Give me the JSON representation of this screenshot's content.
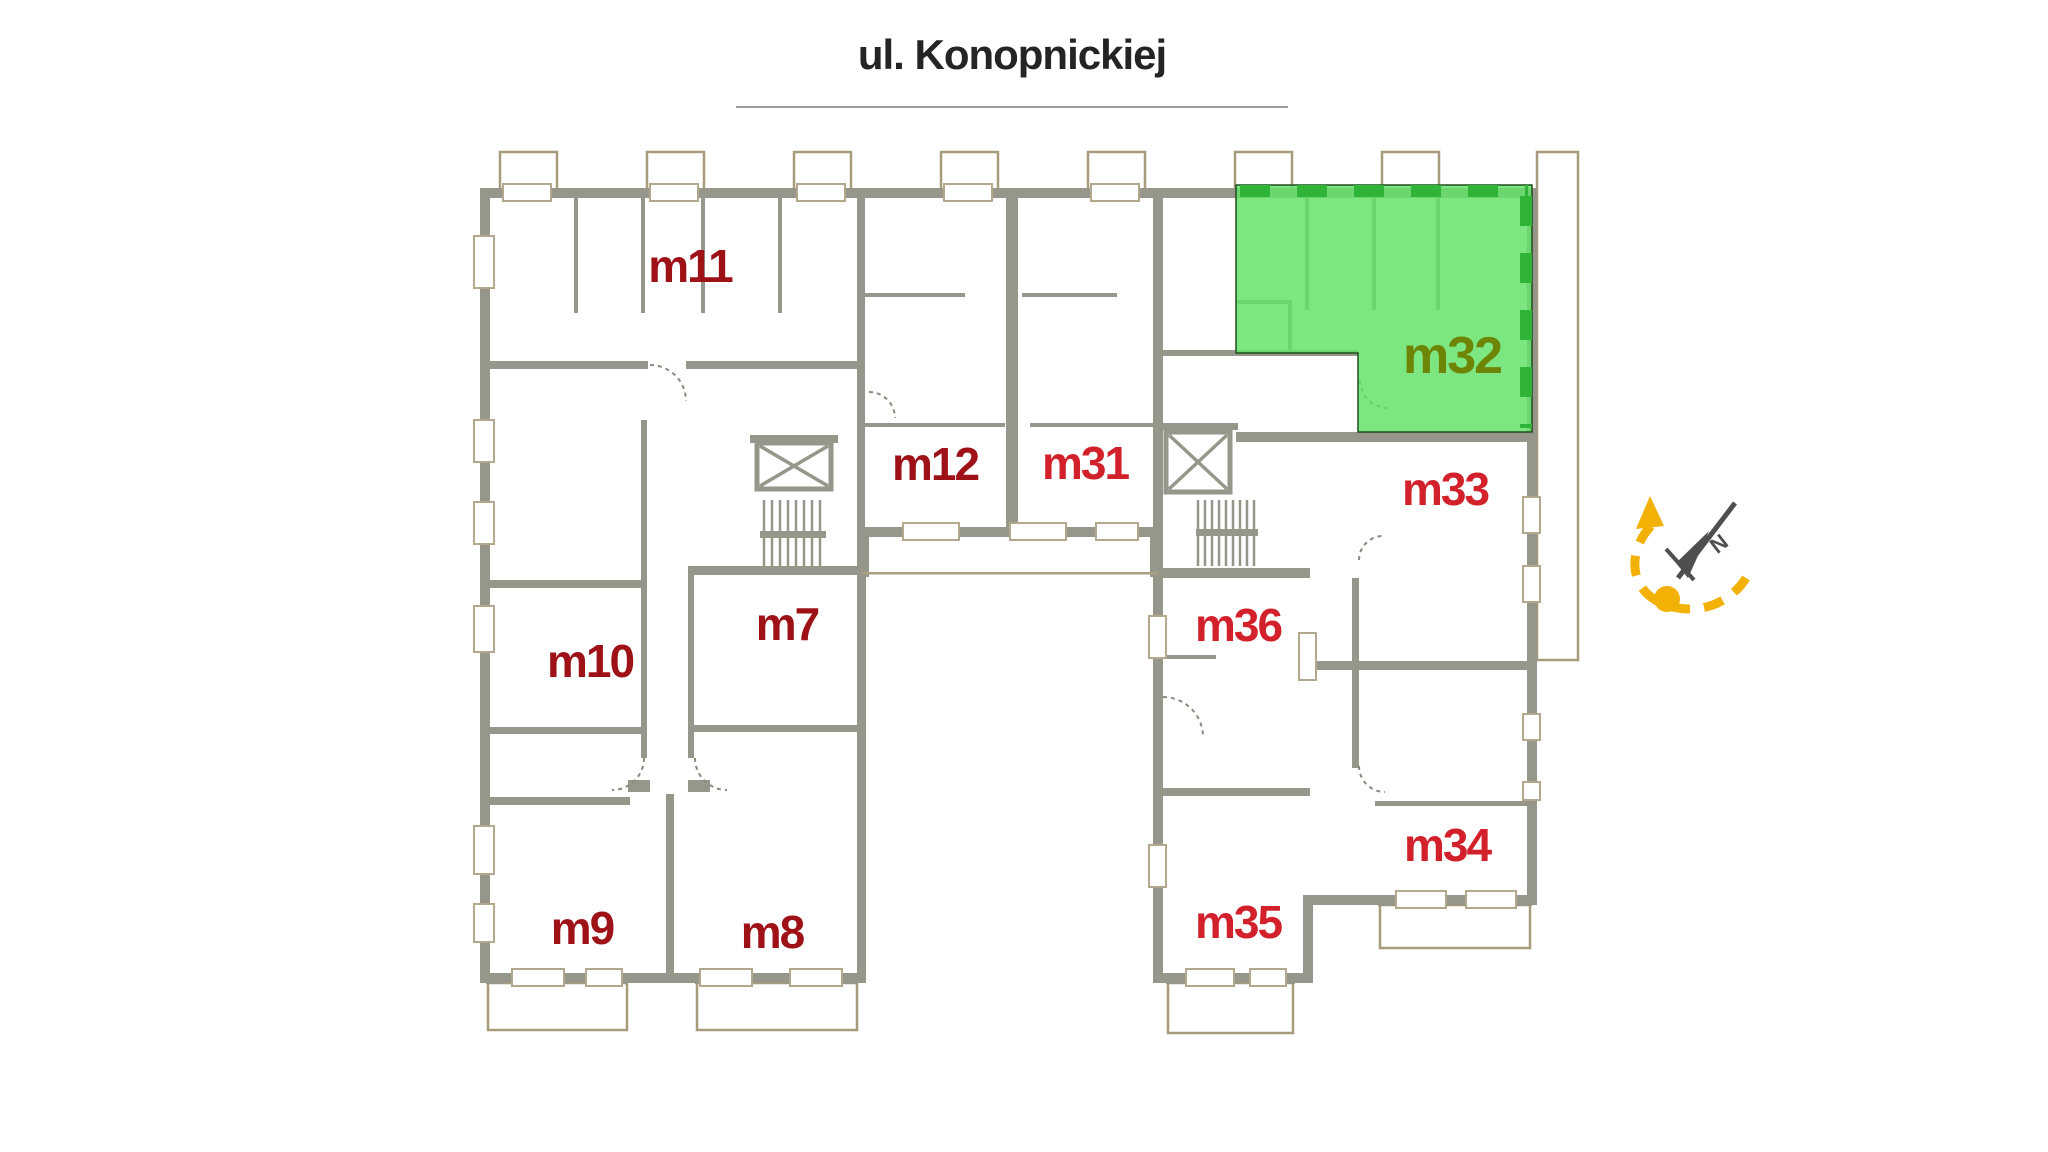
{
  "header": {
    "street_name": "ul. Konopnickiej"
  },
  "floor_plan": {
    "highlighted_apartment_id": "m32",
    "apartments": [
      {
        "id": "m11",
        "label": "m11",
        "highlighted": false
      },
      {
        "id": "m12",
        "label": "m12",
        "highlighted": false
      },
      {
        "id": "m31",
        "label": "m31",
        "highlighted": false
      },
      {
        "id": "m32",
        "label": "m32",
        "highlighted": true
      },
      {
        "id": "m33",
        "label": "m33",
        "highlighted": false
      },
      {
        "id": "m7",
        "label": "m7",
        "highlighted": false
      },
      {
        "id": "m10",
        "label": "m10",
        "highlighted": false
      },
      {
        "id": "m36",
        "label": "m36",
        "highlighted": false
      },
      {
        "id": "m34",
        "label": "m34",
        "highlighted": false
      },
      {
        "id": "m35",
        "label": "m35",
        "highlighted": false
      },
      {
        "id": "m9",
        "label": "m9",
        "highlighted": false
      },
      {
        "id": "m8",
        "label": "m8",
        "highlighted": false
      }
    ],
    "compass": {
      "north_label": "N"
    }
  },
  "colors": {
    "wall": "#97968a",
    "balcony_line": "#a89b7c",
    "window_frame": "#b3a88e",
    "label_dark_red": "#9e1117",
    "label_bright_red": "#d2212b",
    "highlight_fill": "#63e268",
    "highlight_dash": "#2fb438",
    "highlight_label_olive": "#6e8405",
    "compass_yellow": "#f3b106",
    "compass_needle_gray": "#4f4f4f",
    "title_text": "#242424",
    "title_underline": "#9c9c9c"
  }
}
